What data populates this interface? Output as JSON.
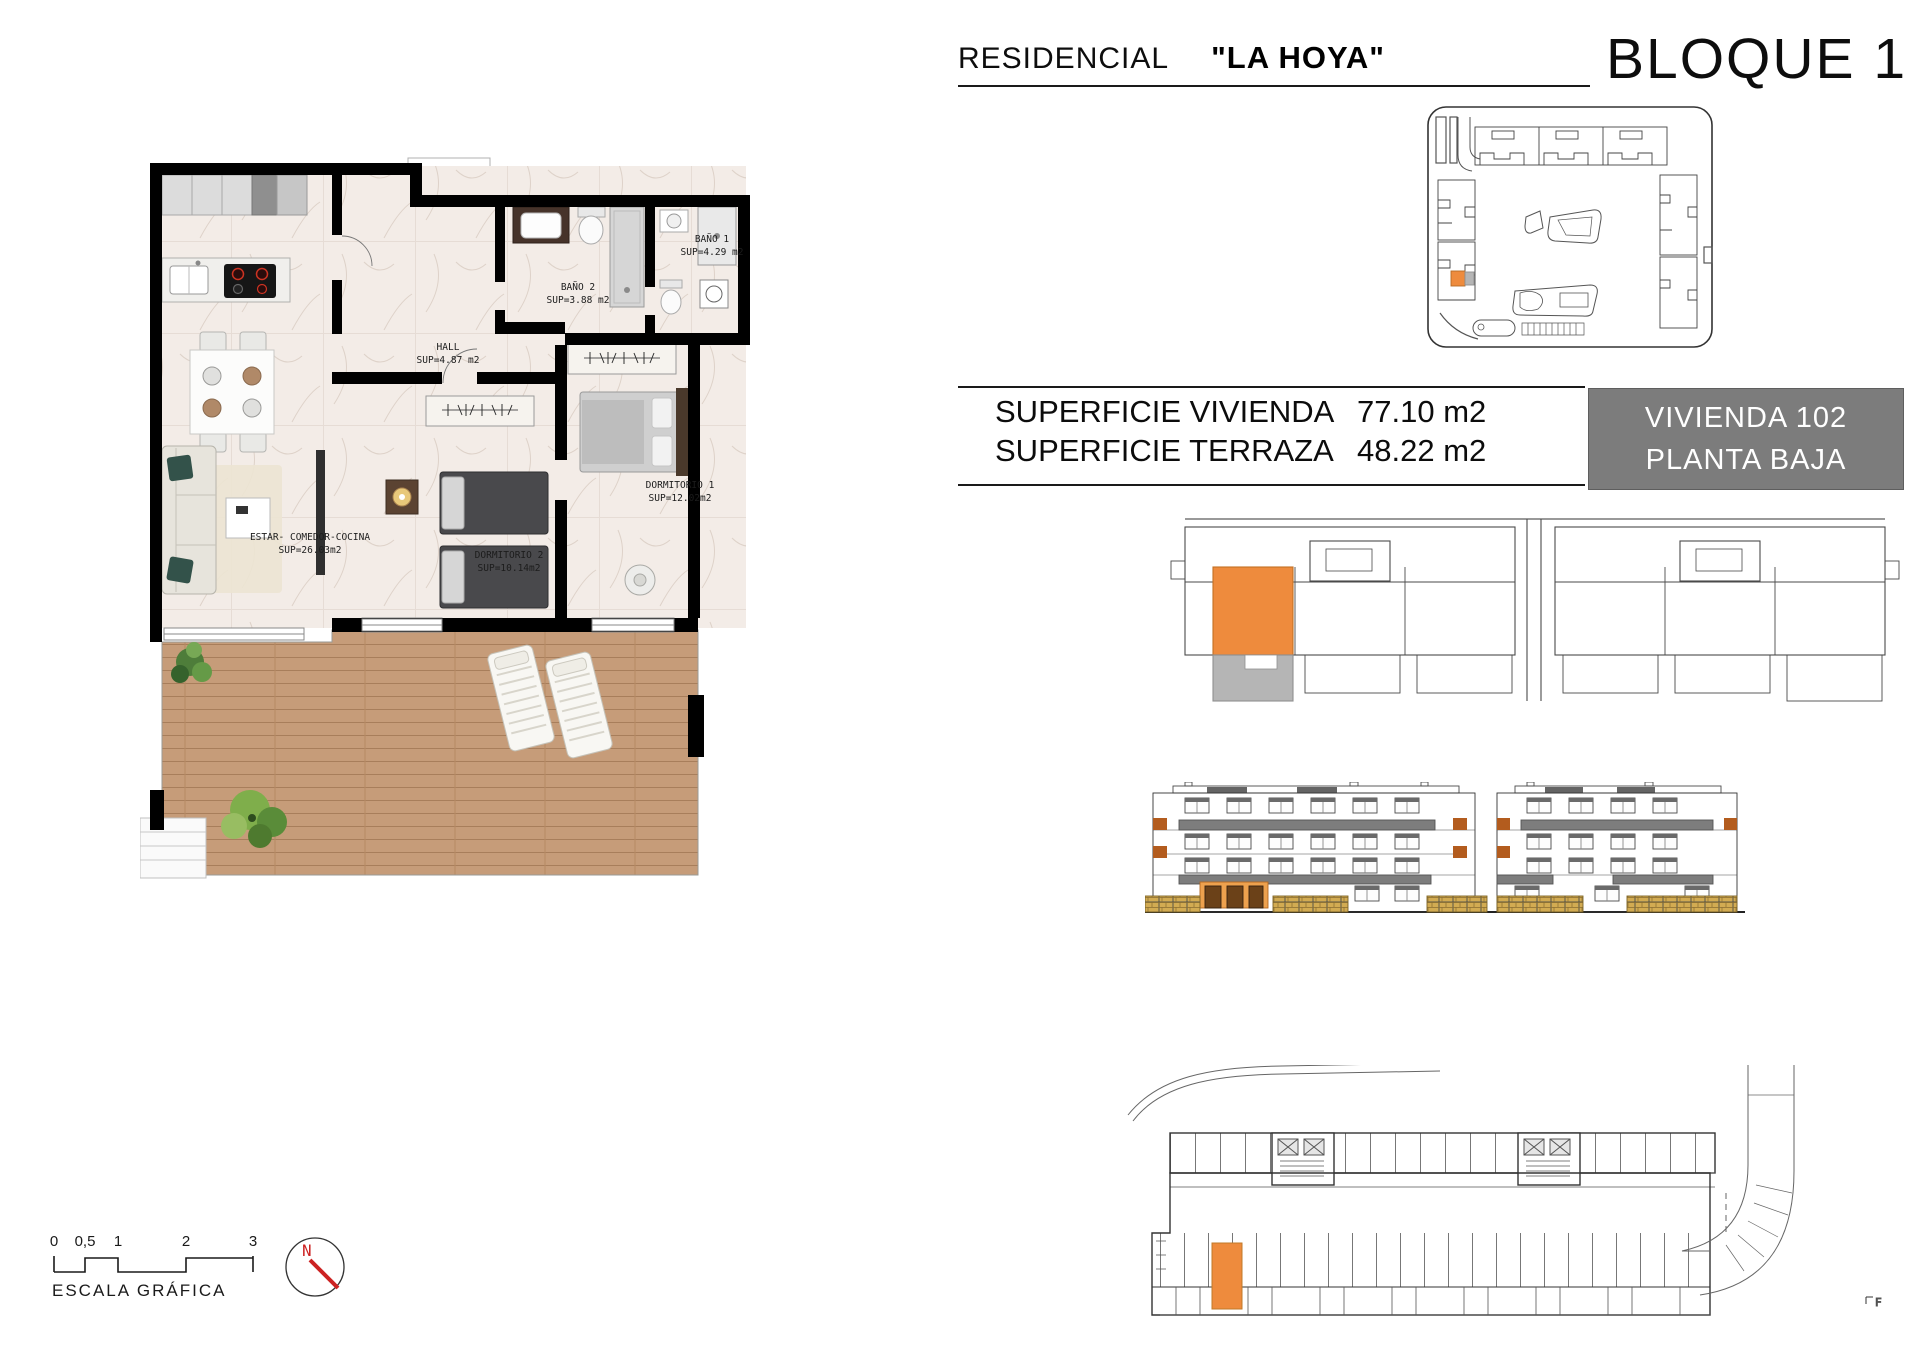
{
  "header": {
    "residencial_label": "RESIDENCIAL",
    "project_name": "\"LA HOYA\"",
    "block_title": "BLOQUE 1"
  },
  "surface_table": {
    "rows": [
      {
        "label": "SUPERFICIE VIVIENDA",
        "value": "77.10 m2"
      },
      {
        "label": "SUPERFICIE TERRAZA",
        "value": "48.22 m2"
      }
    ],
    "unit_box": {
      "line1": "VIVIENDA 102",
      "line2": "PLANTA BAJA"
    }
  },
  "floorplan": {
    "rooms": [
      {
        "name": "BAÑO 1",
        "area": "SUP=4.29 m2"
      },
      {
        "name": "BAÑO 2",
        "area": "SUP=3.88 m2"
      },
      {
        "name": "HALL",
        "area": "SUP=4.87 m2"
      },
      {
        "name": "DORMITORIO 1",
        "area": "SUP=12.02m2"
      },
      {
        "name": "DORMITORIO 2",
        "area": "SUP=10.14m2"
      },
      {
        "name": "ESTAR- COMEDOR-COCINA",
        "area": "SUP=26.03m2"
      }
    ]
  },
  "scale_bar": {
    "ticks": [
      "0",
      "0,5",
      "1",
      "2",
      "3"
    ],
    "label": "ESCALA GRÁFICA"
  },
  "compass": {
    "north_label": "N"
  },
  "garage_plan": {
    "corner_mark": "F"
  },
  "colors": {
    "accent_orange": "#EE8B3D",
    "ground_unit_orange": "#EDA14E",
    "terrace_gray": "#B5B5B5",
    "unit_box_gray": "#7C7C7C",
    "balcony_gray": "#7D7D7D",
    "fence_tan": "#D2AB52",
    "wood_floor": "#C69C79",
    "marble_floor": "#F3ECE7",
    "compass_red": "#CC2222"
  }
}
